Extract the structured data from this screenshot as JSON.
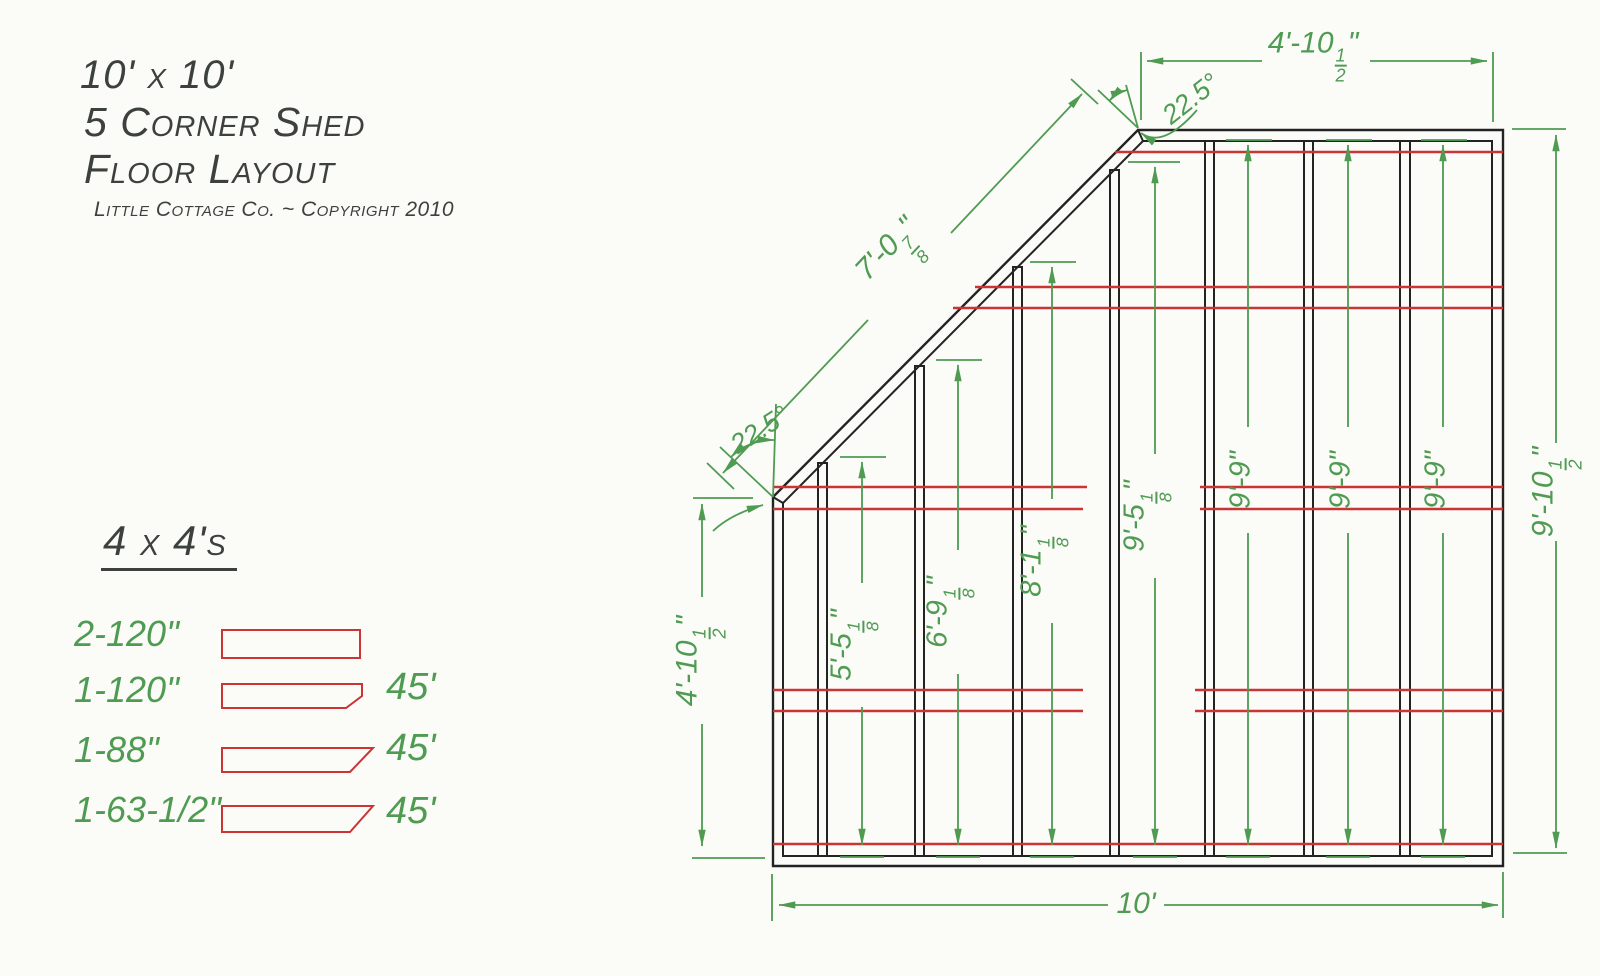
{
  "title": {
    "size_line": "10' x 10'",
    "name_line1": "5 Corner Shed",
    "name_line2": "Floor Layout",
    "copyright": "Little Cottage Co. ~ Copyright 2010"
  },
  "legend": {
    "header": "4 x 4's",
    "rows": [
      {
        "count_length": "2-120\"",
        "cut": ""
      },
      {
        "count_length": "1-120\"",
        "cut": "45'"
      },
      {
        "count_length": "1-88\"",
        "cut": "45'"
      },
      {
        "count_length": "1-63-1/2\"",
        "cut": "45'"
      }
    ]
  },
  "dims": {
    "top_width": "4'-10½\"",
    "diagonal": "7'-0⅞\"",
    "left_height": "4'-10½\"",
    "right_height": "9'-10½\"",
    "bottom_width": "10'",
    "angle_top": "22.5°",
    "angle_bottom": "22.5°",
    "joists": [
      "5'-5⅛\"",
      "6'-9⅛\"",
      "8'-1⅛\"",
      "9'-5⅛\"",
      "9'-9\"",
      "9'-9\"",
      "9'-9\""
    ]
  },
  "colors": {
    "dimension_green": "#4f9b52",
    "runner_red": "#cb3434",
    "frame_black": "#232323",
    "title_ink": "#3d413d"
  }
}
